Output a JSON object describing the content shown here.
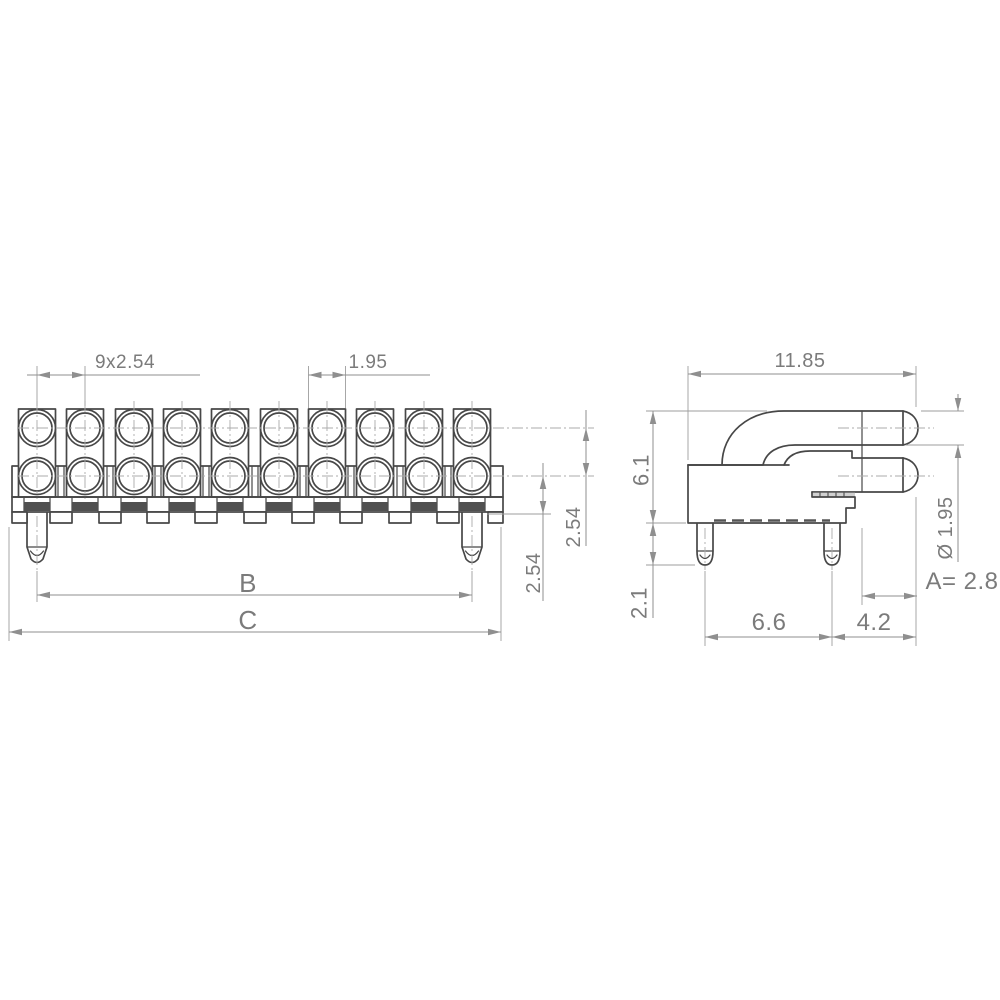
{
  "drawing": {
    "front_view": {
      "dim_pitch": "9x2.54",
      "dim_lens_width": "1.95",
      "dim_row_pitch": "2.54",
      "dim_row_offset": "2.54",
      "dim_pin_span": "B",
      "dim_overall_width": "C"
    },
    "side_view": {
      "dim_depth": "11.85",
      "dim_height": "6.1",
      "dim_pin_length": "2.1",
      "dim_pin_to_front": "6.6",
      "dim_front_to_tip": "4.2",
      "dim_lens_diameter": "Ø 1.95",
      "dim_protrusion": "A= 2.8"
    }
  }
}
